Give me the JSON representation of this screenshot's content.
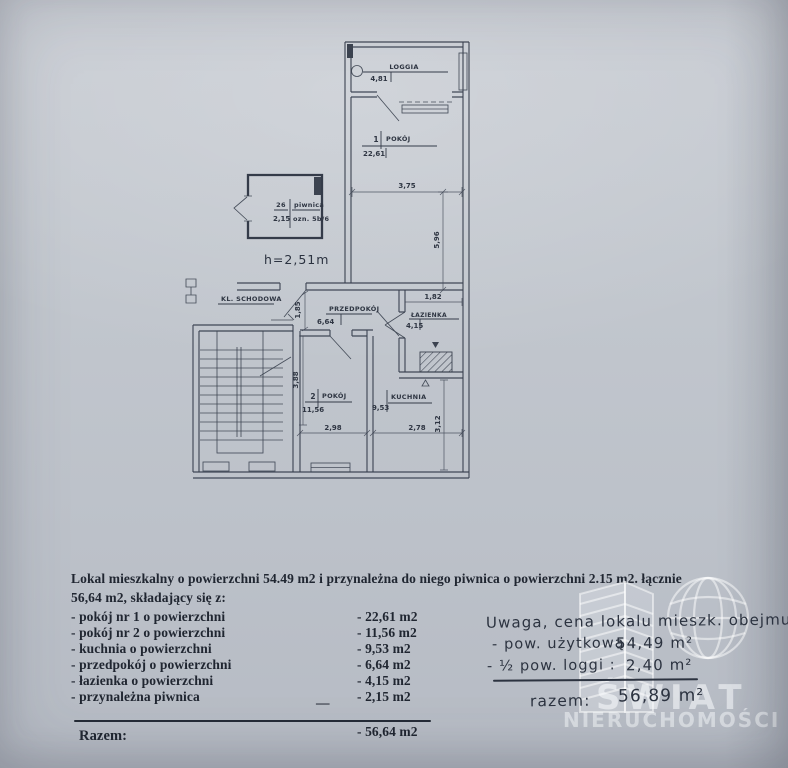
{
  "plan": {
    "loggia": {
      "label": "LOGGIA",
      "area": "4,81"
    },
    "room1": {
      "num": "1",
      "label": "POKÓJ",
      "area": "22,61"
    },
    "piwnica": {
      "num": "26",
      "label": "piwnica",
      "area": "2,15",
      "ozn": "ozn. 5b/6",
      "height": "h=2,51m"
    },
    "staircase": {
      "label": "KL. SCHODOWA"
    },
    "hall": {
      "label": "PRZEDPOKÓJ",
      "area": "6,64"
    },
    "bath": {
      "label": "ŁAZIENKA",
      "area": "4,15"
    },
    "room2": {
      "num": "2",
      "label": "POKÓJ",
      "area": "11,56"
    },
    "kitchen": {
      "label": "KUCHNIA",
      "area": "9,53"
    },
    "dims": {
      "room1_w": "3,75",
      "room1_h": "5,96",
      "hall_h": "1,85",
      "bath_w": "1,82",
      "room2_h": "3,88",
      "room2_w": "2,98",
      "kitchen_w": "2,78",
      "kitchen_h": "3,12"
    }
  },
  "description": {
    "line1": "Lokal mieszkalny o powierzchni 54.49 m2 i przynależna do niego piwnica o powierzchni 2.15 m2. łącznie",
    "line2": "56,64 m2, składający się z:",
    "items": [
      {
        "label": "- pokój nr 1 o powierzchni",
        "value": "- 22,61 m2"
      },
      {
        "label": "- pokój nr 2 o powierzchni",
        "value": "- 11,56 m2"
      },
      {
        "label": "- kuchnia o powierzchni",
        "value": "- 9,53 m2"
      },
      {
        "label": "- przedpokój  o powierzchni",
        "value": "- 6,64  m2"
      },
      {
        "label": "- łazienka o powierzchni",
        "value": "- 4,15  m2"
      },
      {
        "label": "- przynależna piwnica",
        "value": "- 2,15  m2"
      }
    ],
    "dash": "—",
    "total_label": "Razem:",
    "total_value": "- 56,64 m2"
  },
  "note": {
    "line1": "Uwaga, cena lokalu mieszk. obejmuje:",
    "row1_label": "- pow. użytkową :",
    "row1_value": "54,49 m²",
    "row2_label": "- ½  pow. loggi :",
    "row2_value": "2,40 m²",
    "total_label": "razem:",
    "total_value": "56,89 m²"
  },
  "watermark": {
    "line1": "ŚWIAT",
    "line2": "NIERUCHOMOŚCI"
  }
}
